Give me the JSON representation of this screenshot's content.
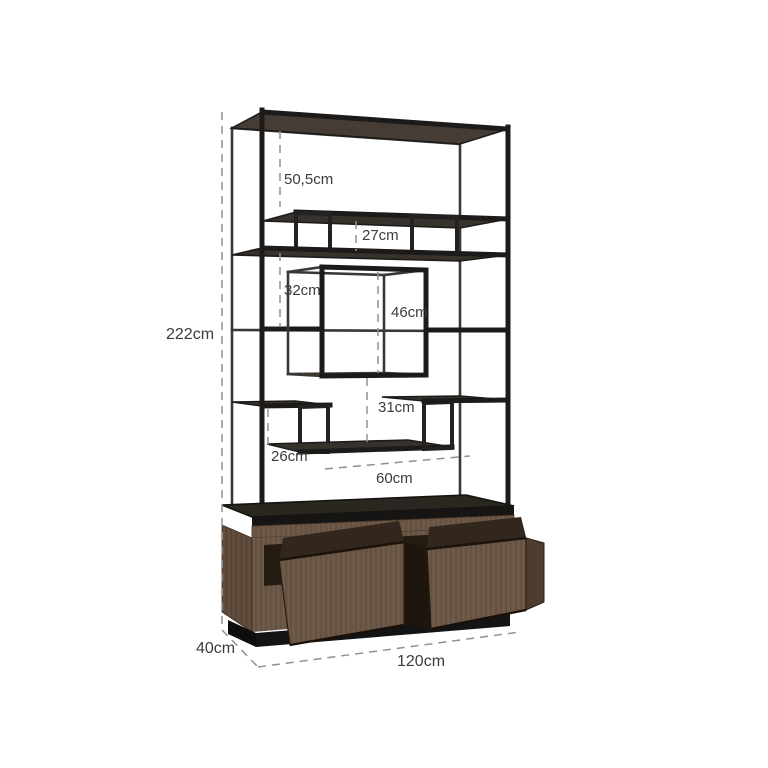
{
  "diagram_title": "shelving-unit-dimension-diagram",
  "dimensions": {
    "height": "222cm",
    "width": "120cm",
    "depth": "40cm",
    "opening_top": "50,5cm",
    "opening_bridge": "27cm",
    "opening_middle": "32cm",
    "cube": "46cm",
    "below_cube": "31cm",
    "opening_lower": "26cm",
    "shelf_width": "60cm"
  },
  "colors": {
    "background": "#ffffff",
    "metal_frame": "#1d1b19",
    "shelf_top": "#37322c",
    "wood": "#6b5747",
    "wood_dark": "#564434",
    "drawer_interior": "#33271d",
    "plinth": "#141414",
    "dimension_line": "#919191",
    "dimension_text": "#3c3c3c"
  }
}
